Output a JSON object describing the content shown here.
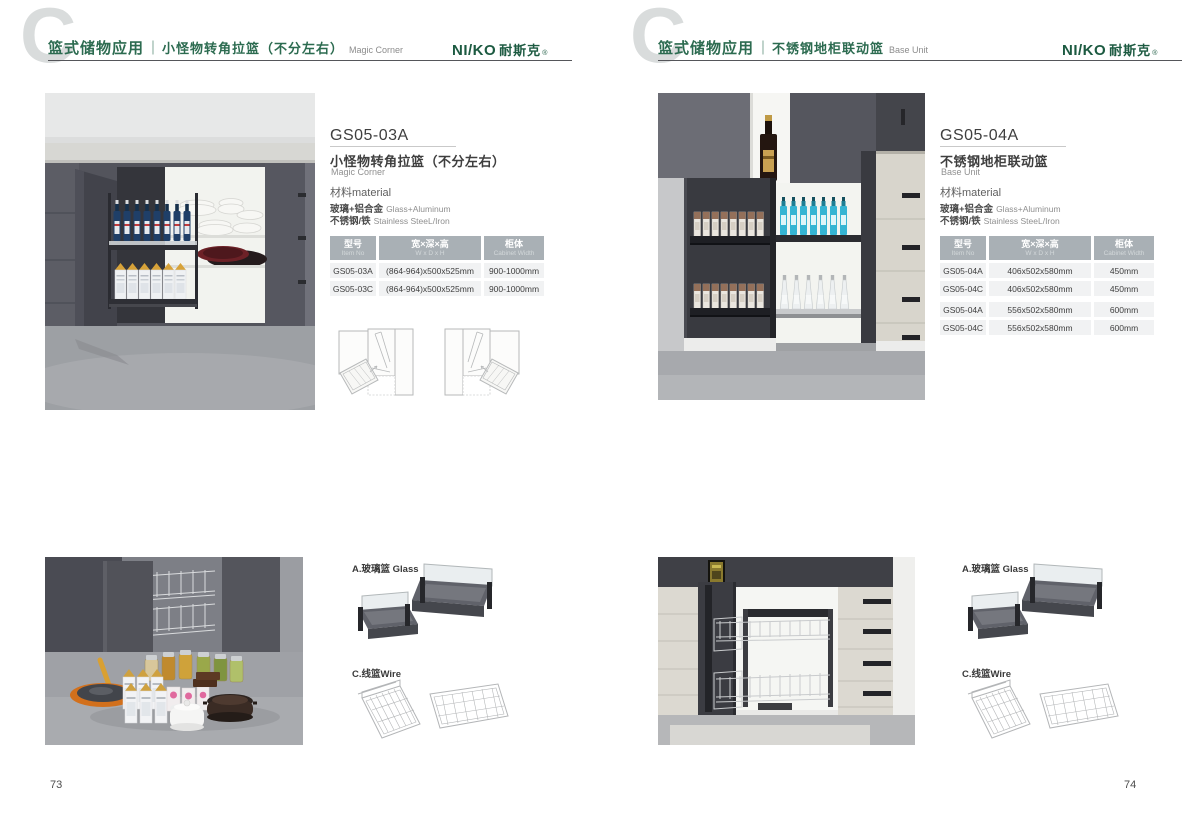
{
  "brand": {
    "logo_en": "NI/KO",
    "logo_cn": "耐斯克",
    "reg": "®",
    "logo_color": "#1c5a41"
  },
  "accent_green": "#2c6b50",
  "left_page": {
    "page_number": "73",
    "header": {
      "category": "篮式储物应用",
      "divider": "｜",
      "title_cn": "小怪物转角拉篮（不分左右）",
      "title_en": "Magic Corner"
    },
    "product": {
      "code": "GS05-03A",
      "name_cn": "小怪物转角拉篮（不分左右）",
      "name_en": "Magic Corner"
    },
    "material": {
      "title": "材料material",
      "row1_cn": "玻璃+铝合金",
      "row1_en": "Glass+Aluminum",
      "row2_cn": "不锈钢/铁",
      "row2_en": "Stainless SteeL/Iron"
    },
    "table": {
      "col1_cn": "型号",
      "col1_en": "Item No",
      "col2_cn": "宽×深×高",
      "col2_en": "W x D x H",
      "col3_cn": "柜体",
      "col3_en": "Cabinet Width",
      "rows": [
        {
          "item": "GS05-03A",
          "size": "(864-964)x500x525mm",
          "cabinet": "900-1000mm"
        },
        {
          "item": "GS05-03C",
          "size": "(864-964)x500x525mm",
          "cabinet": "900-1000mm"
        }
      ]
    },
    "components": {
      "glass": "A.玻璃篮 Glass",
      "wire": "C.线篮Wire"
    }
  },
  "right_page": {
    "page_number": "74",
    "header": {
      "category": "篮式储物应用",
      "divider": "｜",
      "title_cn": "不锈钢地柜联动篮",
      "title_en": "Base Unit"
    },
    "product": {
      "code": "GS05-04A",
      "name_cn": "不锈钢地柜联动篮",
      "name_en": "Base Unit"
    },
    "material": {
      "title": "材料material",
      "row1_cn": "玻璃+铝合金",
      "row1_en": "Glass+Aluminum",
      "row2_cn": "不锈钢/铁",
      "row2_en": "Stainless SteeL/Iron"
    },
    "table": {
      "col1_cn": "型号",
      "col1_en": "Item No",
      "col2_cn": "宽×深×高",
      "col2_en": "W x D x H",
      "col3_cn": "柜体",
      "col3_en": "Cabinet Width",
      "rows": [
        {
          "item": "GS05-04A",
          "size": "406x502x580mm",
          "cabinet": "450mm"
        },
        {
          "item": "GS05-04C",
          "size": "406x502x580mm",
          "cabinet": "450mm"
        },
        {
          "item": "GS05-04A",
          "size": "556x502x580mm",
          "cabinet": "600mm"
        },
        {
          "item": "GS05-04C",
          "size": "556x502x580mm",
          "cabinet": "600mm"
        }
      ]
    },
    "components": {
      "glass": "A.玻璃篮 Glass",
      "wire": "C.线篮Wire"
    }
  }
}
